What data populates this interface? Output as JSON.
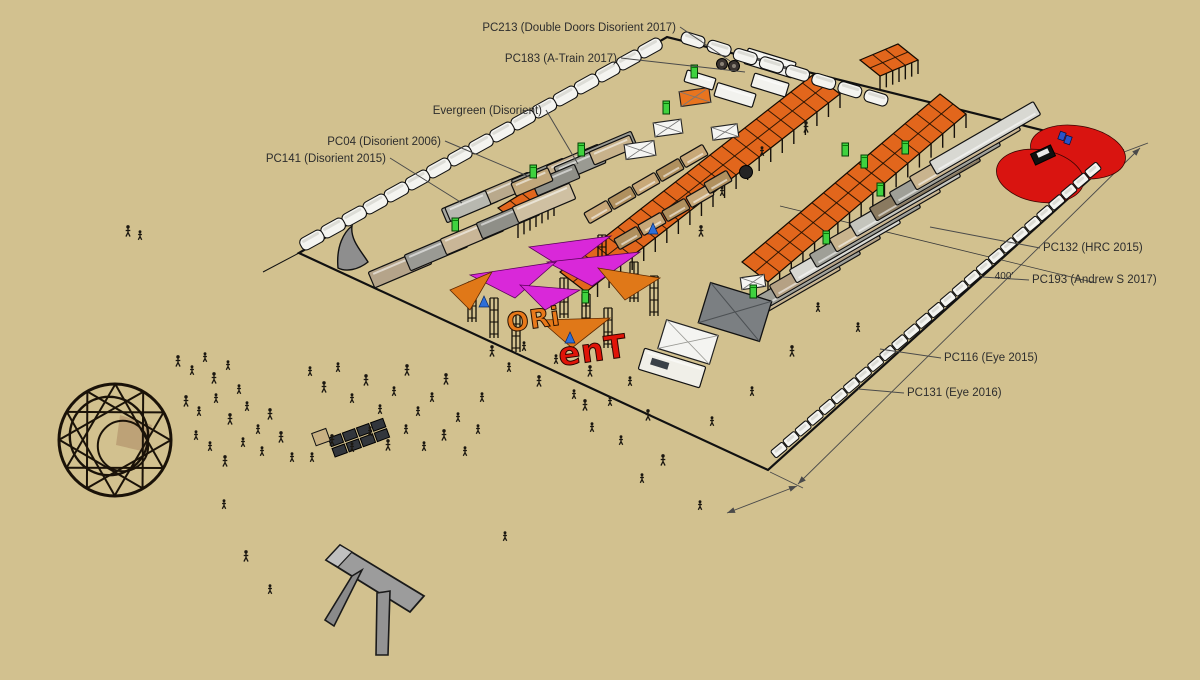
{
  "app": {
    "type": "3d-model-viewport",
    "description": "Camp site plan 3D view with annotation labels"
  },
  "canvas": {
    "width": 1200,
    "height": 680,
    "background": "#d2c18f"
  },
  "colors": {
    "canopy_orange": "#e2661c",
    "sail_magenta": "#d928d9",
    "sail_orange": "#e07818",
    "heart_red": "#d91410",
    "potty_green": "#3fd23f",
    "sign_orange": "#e8791a",
    "sign_red": "#e01408",
    "line_black": "#111111",
    "leader_gray": "#4a4a4a"
  },
  "labels": [
    {
      "id": "pc213",
      "text": "PC213 (Double Doors Disorient 2017)",
      "x": 676,
      "y": 31,
      "anchor": "end",
      "leader": [
        [
          680,
          27
        ],
        [
          730,
          61
        ]
      ]
    },
    {
      "id": "pc183",
      "text": "PC183 (A-Train 2017)",
      "x": 617,
      "y": 62,
      "anchor": "end",
      "leader": [
        [
          621,
          58
        ],
        [
          745,
          72
        ]
      ]
    },
    {
      "id": "evergreen",
      "text": "Evergreen (Disorient)",
      "x": 542,
      "y": 114,
      "anchor": "end",
      "leader": [
        [
          546,
          110
        ],
        [
          578,
          164
        ]
      ]
    },
    {
      "id": "pc04",
      "text": "PC04 (Disorient 2006)",
      "x": 441,
      "y": 145,
      "anchor": "end",
      "leader": [
        [
          445,
          141
        ],
        [
          530,
          177
        ]
      ]
    },
    {
      "id": "pc141",
      "text": "PC141 (Disorient 2015)",
      "x": 386,
      "y": 162,
      "anchor": "end",
      "leader": [
        [
          390,
          158
        ],
        [
          462,
          203
        ]
      ]
    },
    {
      "id": "pc132",
      "text": "PC132 (HRC 2015)",
      "x": 1043,
      "y": 251,
      "anchor": "start",
      "leader": [
        [
          1040,
          248
        ],
        [
          930,
          227
        ]
      ]
    },
    {
      "id": "pc193",
      "text": "PC193 (Andrew S 2017)",
      "x": 1032,
      "y": 283,
      "anchor": "start",
      "leader": [
        [
          1029,
          280
        ],
        [
          982,
          277
        ]
      ]
    },
    {
      "id": "pc116",
      "text": "PC116 (Eye 2015)",
      "x": 944,
      "y": 361,
      "anchor": "start",
      "leader": [
        [
          941,
          358
        ],
        [
          880,
          349
        ]
      ]
    },
    {
      "id": "pc131",
      "text": "PC131 (Eye 2016)",
      "x": 907,
      "y": 396,
      "anchor": "start",
      "leader": [
        [
          904,
          393
        ],
        [
          858,
          389
        ]
      ]
    }
  ],
  "dimension": {
    "text": "400'",
    "x": 1004,
    "y": 279
  },
  "sign": {
    "left": "ORi",
    "right": "enT"
  },
  "lot": {
    "corners": [
      [
        299,
        253
      ],
      [
        667,
        37
      ],
      [
        1122,
        150
      ],
      [
        768,
        470
      ]
    ],
    "street_line": [
      [
        780,
        206
      ],
      [
        1096,
        283
      ]
    ],
    "ext_tail": [
      [
        299,
        253
      ],
      [
        263,
        272
      ]
    ]
  },
  "canopies": [
    {
      "p1": [
        560,
        272
      ],
      "p2": [
        814,
        74
      ],
      "v": [
        26,
        20
      ],
      "cells": 22
    },
    {
      "p1": [
        742,
        262
      ],
      "p2": [
        940,
        94
      ],
      "v": [
        26,
        20
      ],
      "cells": 17
    },
    {
      "p1": [
        860,
        60
      ],
      "p2": [
        898,
        44
      ],
      "v": [
        20,
        16
      ],
      "cells": 3
    },
    {
      "p1": [
        498,
        208
      ],
      "p2": [
        534,
        186
      ],
      "v": [
        20,
        16
      ],
      "cells": 3
    }
  ],
  "vehicle_rows": {
    "top_left_rvs": {
      "from": [
        312,
        240
      ],
      "to": [
        650,
        48
      ],
      "count": 17,
      "rot": -29
    },
    "top_right_rvs": {
      "from": [
        693,
        40
      ],
      "to": [
        876,
        98
      ],
      "count": 8,
      "rot": 17
    },
    "right_cars": {
      "from": [
        1093,
        170
      ],
      "to": [
        779,
        450
      ],
      "count": 27,
      "rot": -40
    },
    "mid_cluster": {
      "start": [
        985,
        138
      ],
      "step": [
        -20,
        15.5
      ],
      "count": 11,
      "rot": 150,
      "len": 120,
      "wid": 15,
      "fills": [
        "#d8d8d2",
        "#c9b48e",
        "#9f9f97",
        "#8a7a60",
        "#c4c4bc",
        "#c9b48e",
        "#9f9f97",
        "#d8d8d2",
        "#b5a184",
        "#9f9f97",
        "#c9b48e"
      ]
    },
    "left_row1": {
      "centers": [
        [
          400,
          268
        ],
        [
          436,
          251
        ],
        [
          472,
          235
        ],
        [
          508,
          219
        ],
        [
          544,
          203
        ]
      ],
      "rot": -23,
      "len": 62,
      "wid": 17,
      "fills": [
        "#b5a48a",
        "#9a9a94",
        "#c9b697",
        "#8f8f88",
        "#cfc0a2"
      ]
    },
    "left_row2": {
      "centers": [
        [
          470,
          205
        ],
        [
          505,
          190
        ],
        [
          540,
          176
        ],
        [
          575,
          162
        ],
        [
          608,
          149
        ]
      ],
      "rot": -23,
      "len": 56,
      "wid": 15,
      "fills": [
        "#a7a79f",
        "#b9a98c",
        "#98988f",
        "#c2ad8c",
        "#9a9a92"
      ]
    },
    "extra_boxes": [
      {
        "c": [
          580,
          165
        ],
        "rot": -23,
        "len": 50,
        "wid": 16,
        "fill": "#9a9a92"
      },
      {
        "c": [
          612,
          150
        ],
        "rot": -23,
        "len": 44,
        "wid": 14,
        "fill": "#c8b28b"
      },
      {
        "c": [
          556,
          180
        ],
        "rot": -23,
        "len": 46,
        "wid": 15,
        "fill": "#8f8f88"
      },
      {
        "c": [
          532,
          182
        ],
        "rot": -23,
        "len": 40,
        "wid": 14,
        "fill": "#c2a87c"
      },
      {
        "c": [
          468,
          206
        ],
        "rot": -23,
        "len": 44,
        "wid": 15,
        "fill": "#b8b8b0"
      }
    ]
  },
  "pallet_stacks": [
    [
      598,
      212
    ],
    [
      622,
      198
    ],
    [
      646,
      184
    ],
    [
      670,
      170
    ],
    [
      694,
      156
    ],
    [
      628,
      238
    ],
    [
      652,
      224
    ],
    [
      676,
      210
    ],
    [
      700,
      196
    ],
    [
      718,
      182
    ]
  ],
  "scaffold_towers": [
    [
      468,
      282
    ],
    [
      490,
      298
    ],
    [
      512,
      312
    ],
    [
      560,
      278
    ],
    [
      582,
      294
    ],
    [
      604,
      308
    ],
    [
      630,
      262
    ],
    [
      650,
      276
    ],
    [
      598,
      235
    ]
  ],
  "sails": {
    "magenta": [
      [
        [
          529,
          247
        ],
        [
          611,
          236
        ],
        [
          566,
          270
        ]
      ],
      [
        [
          547,
          262
        ],
        [
          640,
          252
        ],
        [
          592,
          286
        ]
      ],
      [
        [
          470,
          275
        ],
        [
          556,
          262
        ],
        [
          515,
          298
        ]
      ],
      [
        [
          520,
          285
        ],
        [
          580,
          290
        ],
        [
          545,
          310
        ]
      ]
    ],
    "orange": [
      [
        [
          598,
          268
        ],
        [
          660,
          278
        ],
        [
          625,
          300
        ]
      ],
      [
        [
          450,
          290
        ],
        [
          492,
          272
        ],
        [
          470,
          310
        ]
      ],
      [
        [
          540,
          320
        ],
        [
          610,
          318
        ],
        [
          572,
          348
        ]
      ]
    ],
    "blue": [
      [
        484,
        303
      ],
      [
        570,
        339
      ],
      [
        653,
        230
      ]
    ]
  },
  "tents": {
    "white_pyramids": [
      [
        640,
        150,
        30
      ],
      [
        668,
        128,
        28
      ],
      [
        725,
        132,
        26
      ],
      [
        753,
        282,
        24
      ]
    ],
    "orange_pyramid": [
      695,
      97,
      30
    ],
    "white_boxes": [
      {
        "c": [
          735,
          95
        ],
        "rot": 17,
        "len": 40,
        "wid": 14
      },
      {
        "c": [
          700,
          80
        ],
        "rot": 17,
        "len": 30,
        "wid": 12
      },
      {
        "c": [
          770,
          85
        ],
        "rot": 17,
        "len": 36,
        "wid": 14
      }
    ],
    "a_train": {
      "c": [
        770,
        63
      ],
      "rot": 17,
      "len": 50,
      "wid": 16
    },
    "wheels_art": [
      [
        722,
        64
      ],
      [
        734,
        66
      ]
    ],
    "gray_hip_tent": {
      "c": [
        735,
        312
      ],
      "rot": 17,
      "len": 64,
      "wid": 42
    },
    "white_pavilion": {
      "c": [
        688,
        342
      ],
      "rot": 17,
      "len": 54,
      "wid": 30
    },
    "front_rv": {
      "c": [
        672,
        368
      ],
      "rot": 17,
      "len": 64,
      "wid": 22
    }
  },
  "heart": {
    "lobes": [
      [
        1078,
        152,
        48,
        26
      ],
      [
        1040,
        176,
        44,
        26
      ]
    ],
    "car": {
      "c": [
        1043,
        155
      ],
      "rot": -25,
      "len": 22,
      "wid": 12
    },
    "blue_bits": [
      [
        1062,
        136
      ],
      [
        1068,
        140
      ]
    ]
  },
  "porta_potties": [
    [
      581,
      150
    ],
    [
      666,
      108
    ],
    [
      694,
      72
    ],
    [
      533,
      172
    ],
    [
      455,
      225
    ],
    [
      845,
      150
    ],
    [
      864,
      162
    ],
    [
      905,
      148
    ],
    [
      880,
      190
    ],
    [
      826,
      238
    ],
    [
      753,
      292
    ],
    [
      585,
      297
    ]
  ],
  "ball": [
    746,
    172,
    6.5
  ],
  "solar_array": {
    "c": [
      358,
      438
    ],
    "rot": -20,
    "cols": 4,
    "rows": 2
  },
  "truss_sphere": {
    "c": [
      115,
      440
    ],
    "r": 56
  },
  "people": [
    [
      178,
      362
    ],
    [
      192,
      371
    ],
    [
      205,
      358
    ],
    [
      214,
      379
    ],
    [
      228,
      366
    ],
    [
      239,
      390
    ],
    [
      186,
      402
    ],
    [
      199,
      412
    ],
    [
      216,
      399
    ],
    [
      230,
      420
    ],
    [
      247,
      407
    ],
    [
      258,
      430
    ],
    [
      270,
      415
    ],
    [
      243,
      443
    ],
    [
      262,
      452
    ],
    [
      281,
      438
    ],
    [
      292,
      458
    ],
    [
      210,
      447
    ],
    [
      225,
      462
    ],
    [
      196,
      436
    ],
    [
      310,
      372
    ],
    [
      324,
      388
    ],
    [
      338,
      368
    ],
    [
      352,
      399
    ],
    [
      366,
      381
    ],
    [
      380,
      410
    ],
    [
      394,
      392
    ],
    [
      407,
      371
    ],
    [
      418,
      412
    ],
    [
      432,
      398
    ],
    [
      446,
      380
    ],
    [
      458,
      418
    ],
    [
      370,
      432
    ],
    [
      388,
      446
    ],
    [
      406,
      430
    ],
    [
      352,
      448
    ],
    [
      332,
      441
    ],
    [
      312,
      458
    ],
    [
      424,
      447
    ],
    [
      444,
      436
    ],
    [
      465,
      452
    ],
    [
      478,
      430
    ],
    [
      492,
      352
    ],
    [
      509,
      368
    ],
    [
      524,
      347
    ],
    [
      539,
      382
    ],
    [
      556,
      360
    ],
    [
      574,
      395
    ],
    [
      590,
      372
    ],
    [
      610,
      402
    ],
    [
      630,
      382
    ],
    [
      648,
      416
    ],
    [
      592,
      428
    ],
    [
      482,
      398
    ],
    [
      585,
      406
    ],
    [
      621,
      441
    ],
    [
      642,
      479
    ],
    [
      663,
      461
    ],
    [
      700,
      506
    ],
    [
      505,
      537
    ],
    [
      246,
      557
    ],
    [
      270,
      590
    ],
    [
      224,
      505
    ],
    [
      806,
      128
    ],
    [
      762,
      152
    ],
    [
      722,
      192
    ],
    [
      701,
      232
    ],
    [
      818,
      308
    ],
    [
      858,
      328
    ],
    [
      792,
      352
    ],
    [
      752,
      392
    ],
    [
      712,
      422
    ],
    [
      128,
      232
    ],
    [
      140,
      236
    ]
  ]
}
